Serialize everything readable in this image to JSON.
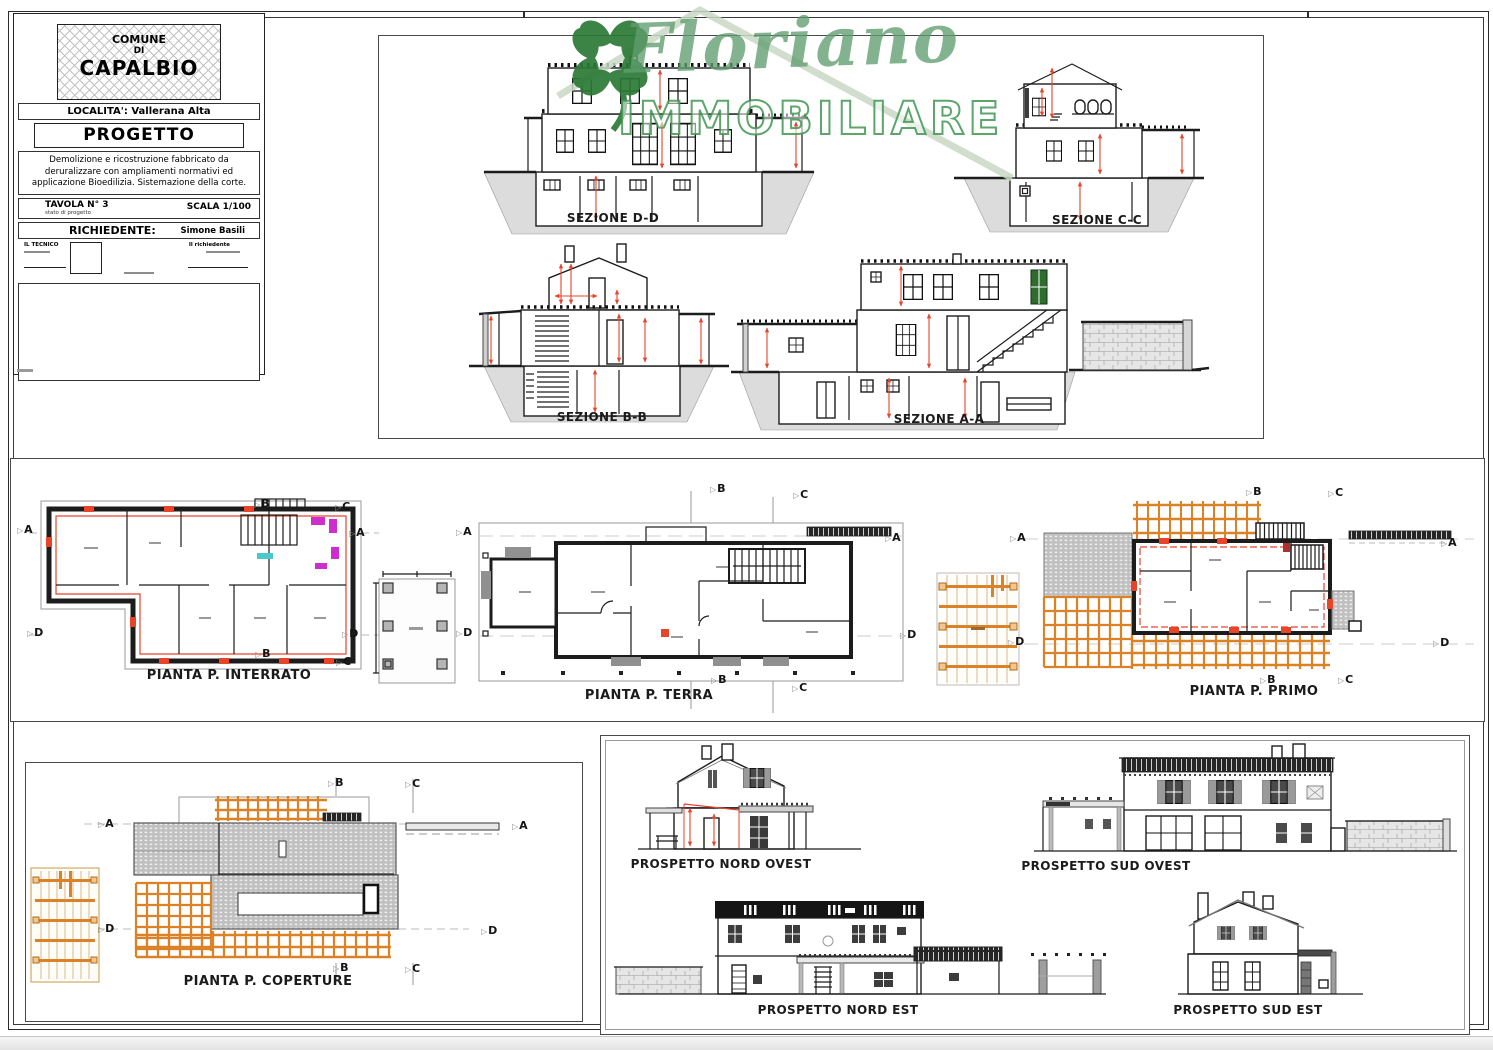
{
  "title_block": {
    "comune_line1": "COMUNE",
    "comune_line2": "DI",
    "comune_line3": "CAPALBIO",
    "localita": "LOCALITA': Vallerana Alta",
    "progetto": "PROGETTO",
    "descrizione": "Demolizione e ricostruzione fabbricato da deruralizzare con ampliamenti normativi ed applicazione Bioedilizia. Sistemazione della corte.",
    "tavola": "TAVOLA N° 3",
    "tavola_sub": "stato di progetto",
    "scala": "SCALA 1/100",
    "richiedente_label": "RICHIEDENTE:",
    "richiedente_name": "Simone Basili",
    "tecnico_label": "IL TECNICO",
    "firma_label": "Il richiedente"
  },
  "watermark": {
    "name": "Floriano",
    "subtitle": "IMMOBILIARE",
    "clover_color": "#2c7a36",
    "script_color": "#609e6e",
    "outline_color": "#3f9651"
  },
  "sections": {
    "dd": "SEZIONE D-D",
    "cc": "SEZIONE C-C",
    "bb": "SEZIONE B-B",
    "aa": "SEZIONE A-A"
  },
  "plans": {
    "interrato": "PIANTA P. INTERRATO",
    "terra": "PIANTA P. TERRA",
    "primo": "PIANTA P. PRIMO",
    "coperture": "PIANTA P. COPERTURE"
  },
  "elevations": {
    "nord_ovest": "PROSPETTO NORD OVEST",
    "sud_ovest": "PROSPETTO SUD OVEST",
    "nord_est": "PROSPETTO NORD EST",
    "sud_est": "PROSPETTO SUD EST"
  },
  "markers": {
    "a": "A",
    "b": "B",
    "c": "C",
    "d": "D"
  },
  "colors": {
    "dimension_red": "#e8442a",
    "pergola_orange": "#dd8126",
    "hatch_gray": "#c9c9c9",
    "ground_gray": "#d9d9d9",
    "line_black": "#1c1c1c",
    "detail_magenta": "#cf2ecf",
    "detail_cyan": "#49c9c9",
    "door_green": "#2f6d2f",
    "paper_white": "#ffffff"
  }
}
